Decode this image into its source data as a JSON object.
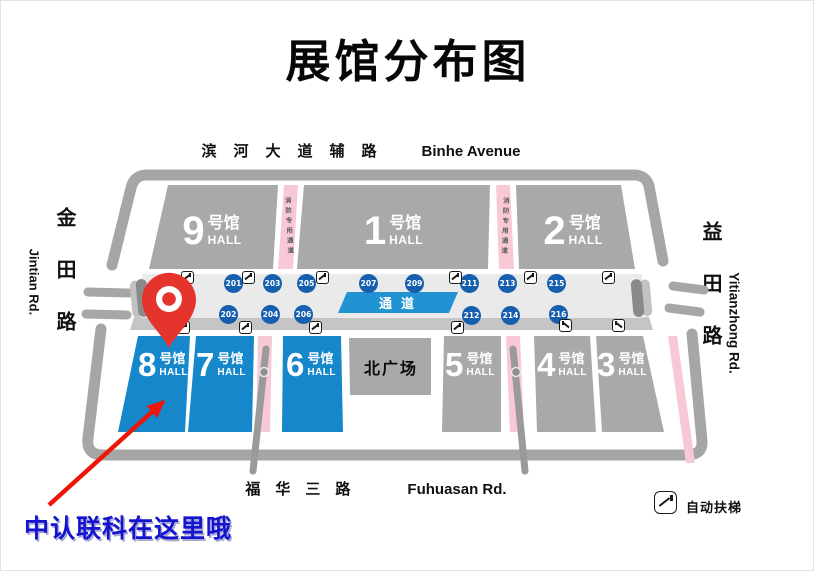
{
  "title": "展馆分布图",
  "roads": {
    "top": {
      "cn": "滨河大道辅路",
      "en": "Binhe Avenue"
    },
    "bottom": {
      "cn": "福华三路",
      "en": "Fuhuasan Rd."
    },
    "left": {
      "cn": "金田路",
      "en": "Jintian Rd."
    },
    "right": {
      "cn": "益田路",
      "en": "Yitianzhong Rd."
    }
  },
  "map": {
    "corridor_label": "通道",
    "fire_lane_label": "消防专用通道",
    "north_plaza_label": "北广场",
    "halls_top": [
      {
        "num": "9",
        "name": "号馆",
        "sub": "HALL"
      },
      {
        "num": "1",
        "name": "号馆",
        "sub": "HALL"
      },
      {
        "num": "2",
        "name": "号馆",
        "sub": "HALL"
      }
    ],
    "halls_bottom": [
      {
        "num": "8",
        "name": "号馆",
        "sub": "HALL",
        "highlight": true
      },
      {
        "num": "7",
        "name": "号馆",
        "sub": "HALL",
        "highlight": true
      },
      {
        "num": "6",
        "name": "号馆",
        "sub": "HALL",
        "highlight": true
      },
      {
        "num": "5",
        "name": "号馆",
        "sub": "HALL",
        "highlight": false
      },
      {
        "num": "4",
        "name": "号馆",
        "sub": "HALL",
        "highlight": false
      },
      {
        "num": "3",
        "name": "号馆",
        "sub": "HALL",
        "highlight": false
      }
    ],
    "gates_top": [
      "201",
      "203",
      "205",
      "207",
      "209",
      "211",
      "213",
      "215"
    ],
    "gates_bottom": [
      "202",
      "204",
      "206",
      "212",
      "214",
      "216"
    ]
  },
  "legend": {
    "escalator_label": "自动扶梯"
  },
  "annotation": {
    "text": "中认联科在这里哦"
  },
  "colors": {
    "hall_blue": "#1787cb",
    "hall_gray": "#a9a9a9",
    "wall_gray": "#a6a6a6",
    "corridor_gray": "#eaeaea",
    "gate_blue": "#155fae",
    "corridor_band_blue": "#2193d2",
    "fire_lane_pink": "#f8c9d4",
    "pin_red": "#e5342c",
    "arrow_red": "#ee1509",
    "note_blue": "#1414cf"
  }
}
